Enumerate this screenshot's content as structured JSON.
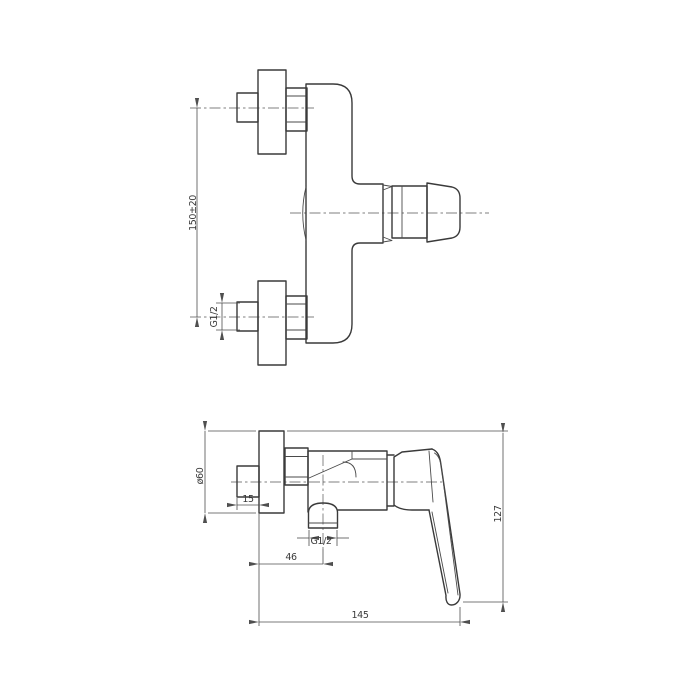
{
  "document": {
    "background_color": "#ffffff",
    "object_line_color": "#3a3a3a",
    "dimension_line_color": "#4f4f4f"
  },
  "front_view": {
    "dim_mounting_distance": "150±20",
    "dim_inlet_thread": "G1/2"
  },
  "side_view": {
    "dim_escutcheon_diameter": "ø60",
    "dim_eccentric_depth": "15",
    "dim_outlet_thread": "G1/2",
    "dim_wall_to_outlet": "46",
    "dim_overall_height": "127",
    "dim_overall_depth": "145"
  }
}
